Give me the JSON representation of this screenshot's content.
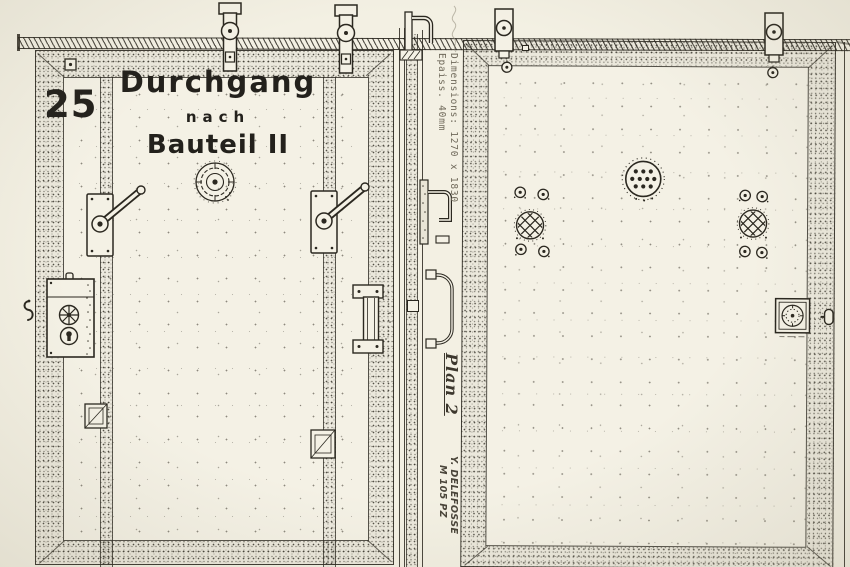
{
  "document": {
    "kind": "scanned technical drawing of two sliding armored doors",
    "colors": {
      "paper": "#f3f0e3",
      "ink": "#2b2820",
      "typewriter_text": "#6f695a",
      "pencil_note": "#8d8776"
    }
  },
  "left_door": {
    "number": "25",
    "label": {
      "line1": "Durchgang",
      "line2": "nach",
      "line3": "Bauteil II"
    }
  },
  "annotations": {
    "dimensions": "Dimensions: 1270 x 1830",
    "thickness": "Epaiss. 40mm",
    "plan": "Plan 2",
    "author": "Y. DELEFOSSE",
    "reference": "M 105 PZ"
  },
  "icons": {
    "roller-hanger-icon": "sliding-door roller hanger bracket on top rail",
    "bolt-icon": "small bolt head",
    "lever-handle-icon": "latch lever handle on mounting plate",
    "lock-plate-icon": "lock plate with spoked knob and keyhole",
    "pull-handle-icon": "vertical pull handle",
    "rosette-icon": "round rosette fitting",
    "vent-grille-icon": "circular ventilation grille with drilled holes",
    "valve-rosette-icon": "round fitting with cross-hatched face",
    "hinge-plate-icon": "small hinge / guide plate",
    "hook-icon": "wall hook at door edge",
    "knob-icon": "knob on door edge",
    "stamp-icon": "square rosette plate",
    "handwritten-note-icon": "faint illegible pencil note"
  }
}
